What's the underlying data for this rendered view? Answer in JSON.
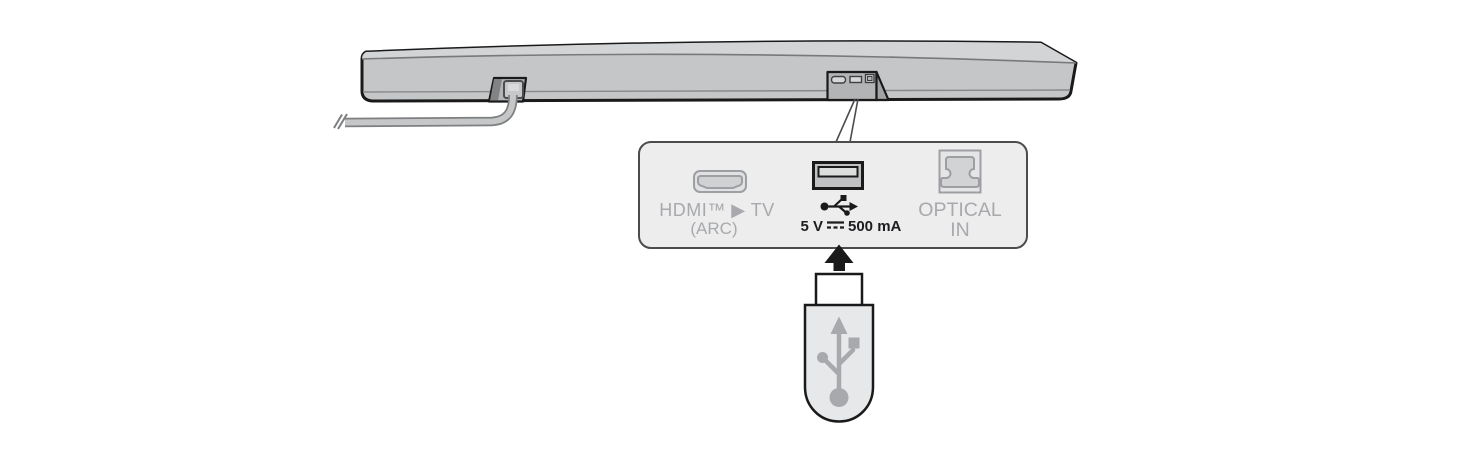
{
  "diagram": {
    "connection_panel": {
      "hdmi": {
        "label": "HDMI™ ▶ TV",
        "sub_label": "(ARC)"
      },
      "usb": {
        "rating_prefix": "5 V",
        "rating_suffix": "500 mA"
      },
      "optical": {
        "label_line1": "OPTICAL",
        "label_line2": "IN"
      }
    },
    "icons": [
      "soundbar-rear-view",
      "power-cable",
      "hdmi-port-icon",
      "usb-port-icon",
      "usb-trident-icon",
      "dc-voltage-symbol",
      "optical-port-icon",
      "insert-arrow-icon",
      "usb-flash-drive",
      "usb-trident-logo-icon"
    ],
    "colors": {
      "label_gray": "#a7a9ac",
      "text_black": "#1d1d1f",
      "panel_fill": "#ededee",
      "panel_border": "#4b4c4e",
      "bar_front": "#c5c6c8",
      "bar_top": "#d3d4d5",
      "usb_body_fill": "#e7e8e9",
      "outline_black": "#1a1a1a"
    }
  }
}
